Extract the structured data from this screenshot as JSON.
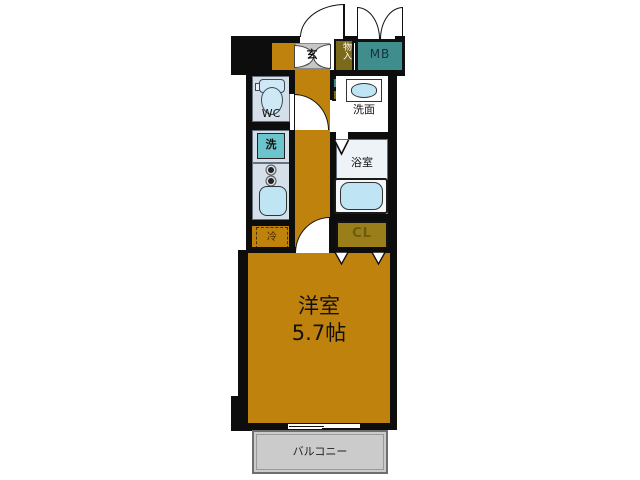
{
  "floor_plan": {
    "title": "apartment-floor-plan",
    "labels": {
      "genkan": "玄",
      "storage": "物入",
      "meter_box": "MB",
      "wc": "WC",
      "washer": "洗",
      "washroom": "洗面",
      "bathroom": "浴室",
      "fridge": "冷",
      "closet": "CL",
      "room_name": "洋室",
      "room_size": "5.7帖",
      "balcony": "バルコニー"
    },
    "colors": {
      "wall": "#0d0d0d",
      "floor_orange": "#bf830d",
      "genkan_gray": "#c6c6c6",
      "meter_box_teal": "#3f8d8d",
      "storage_olive": "#7b6a1a",
      "closet_olive": "#9a7e1a",
      "panel_blue": "#d5dfe9",
      "fixture_blue": "#bfe4f4",
      "washer_teal": "#6cc4cc",
      "balcony_gray": "#cbcbcb"
    }
  }
}
